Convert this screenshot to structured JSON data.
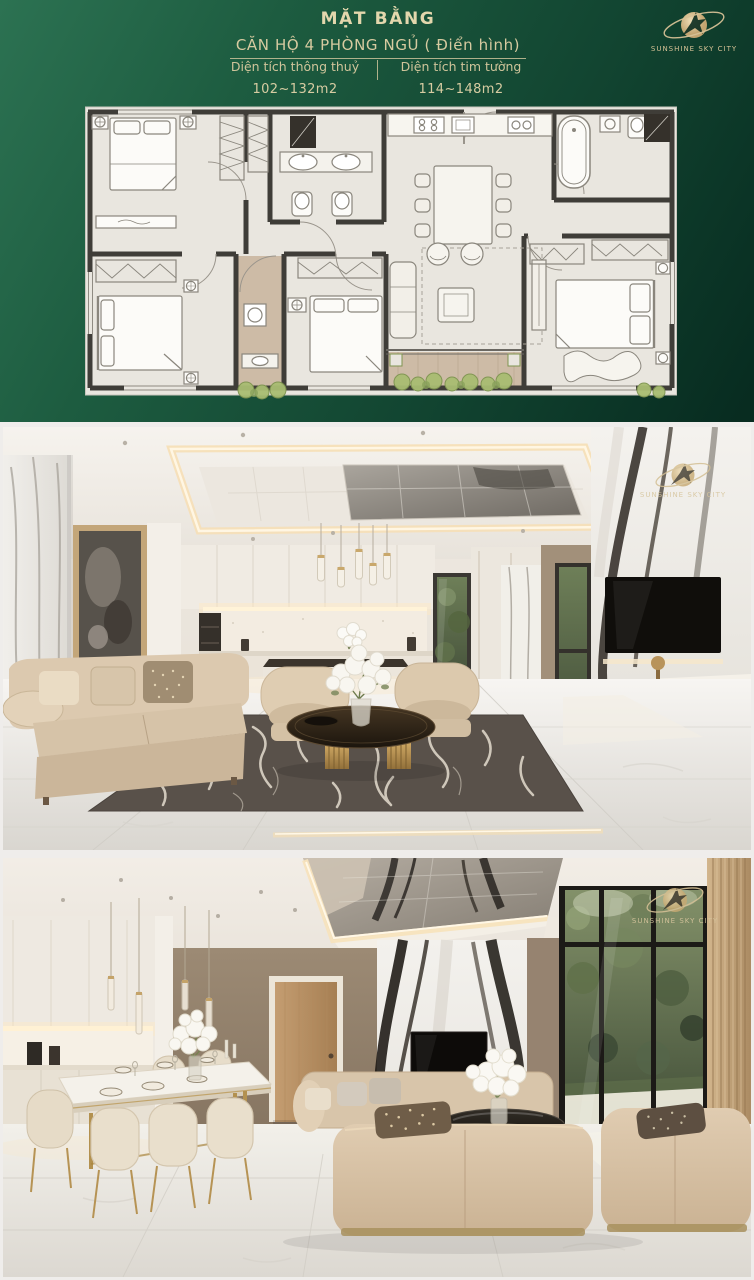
{
  "header": {
    "title": "MẶT BẰNG",
    "subtitle": "CĂN HỘ 4 PHÒNG NGỦ ( Điển hình)",
    "specs": [
      {
        "label": "Diện tích thông thuỷ",
        "value": "102~132m2"
      },
      {
        "label": "Diện tích tim tường",
        "value": "114~148m2"
      }
    ]
  },
  "brand": {
    "name": "SUNSHINE SKY CITY"
  },
  "photos": [
    {
      "alt": "Living room with open kitchen, marble walls, beige sofas and dark patterned rug",
      "watermark": "SUNSHINE SKY CITY"
    },
    {
      "alt": "Dining area and corner sofa with dramatic marble TV wall and garden view windows",
      "watermark": "SUNSHINE SKY CITY"
    }
  ],
  "colors": {
    "background_green_light": "#2c7252",
    "background_green_dark": "#03130e",
    "gold_text": "#d9cda3",
    "plan_floor": "#e9e6df",
    "plan_wall": "#3f3d38",
    "balcony_wood": "#cdbba6",
    "plant_green": "#a9bd72"
  }
}
